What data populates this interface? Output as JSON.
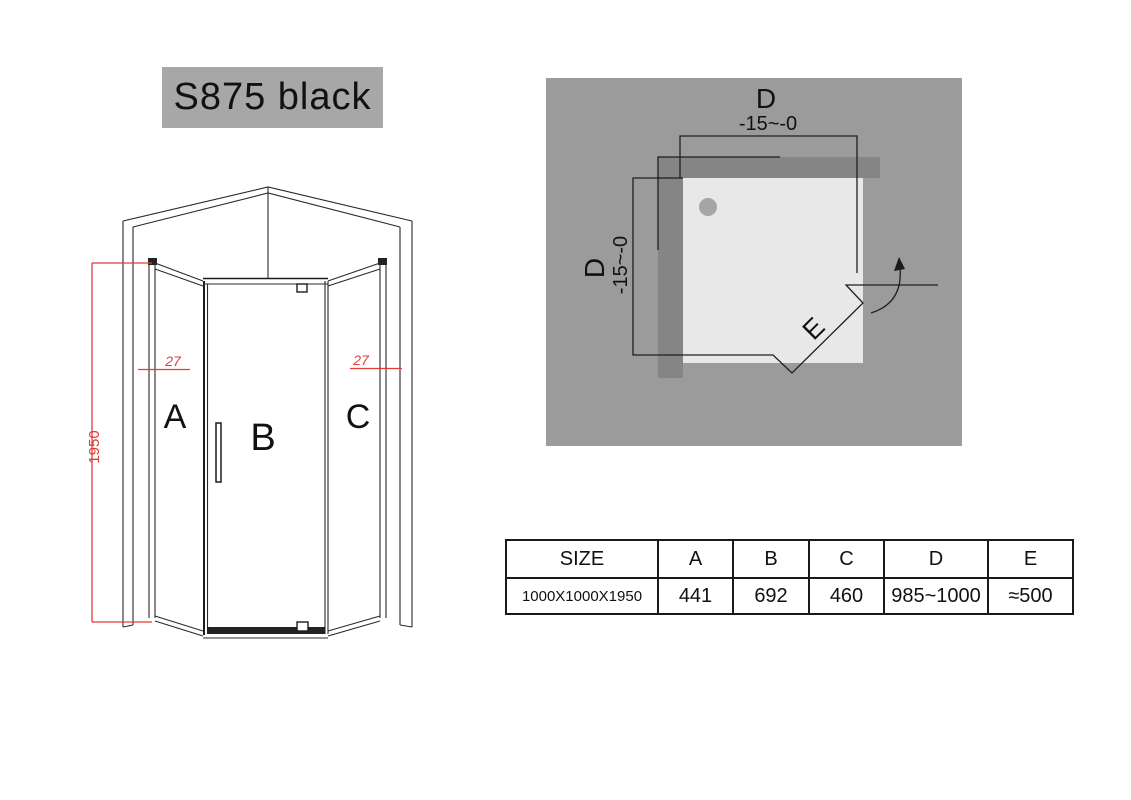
{
  "title": "S875 black",
  "front_view": {
    "dimension_color": "#e23b3b",
    "labels": {
      "panel_a": "A",
      "panel_b": "B",
      "panel_c": "C"
    },
    "dimensions": {
      "height": "1950",
      "left_gap": "27",
      "right_gap": "27"
    }
  },
  "plan_view": {
    "colors": {
      "background": "#9b9b9b",
      "wall": "#858585",
      "tray": "#e8e8e8",
      "drain": "#a6a6a6"
    },
    "labels": {
      "d_top": "D",
      "d_top_tolerance": "-15~-0",
      "d_left": "D",
      "d_left_tolerance": "-15~-0",
      "door": "E"
    }
  },
  "table": {
    "headers": [
      "SIZE",
      "A",
      "B",
      "C",
      "D",
      "E"
    ],
    "rows": [
      [
        "1000X1000X1950",
        "441",
        "692",
        "460",
        "985~1000",
        "≈500"
      ]
    ]
  }
}
